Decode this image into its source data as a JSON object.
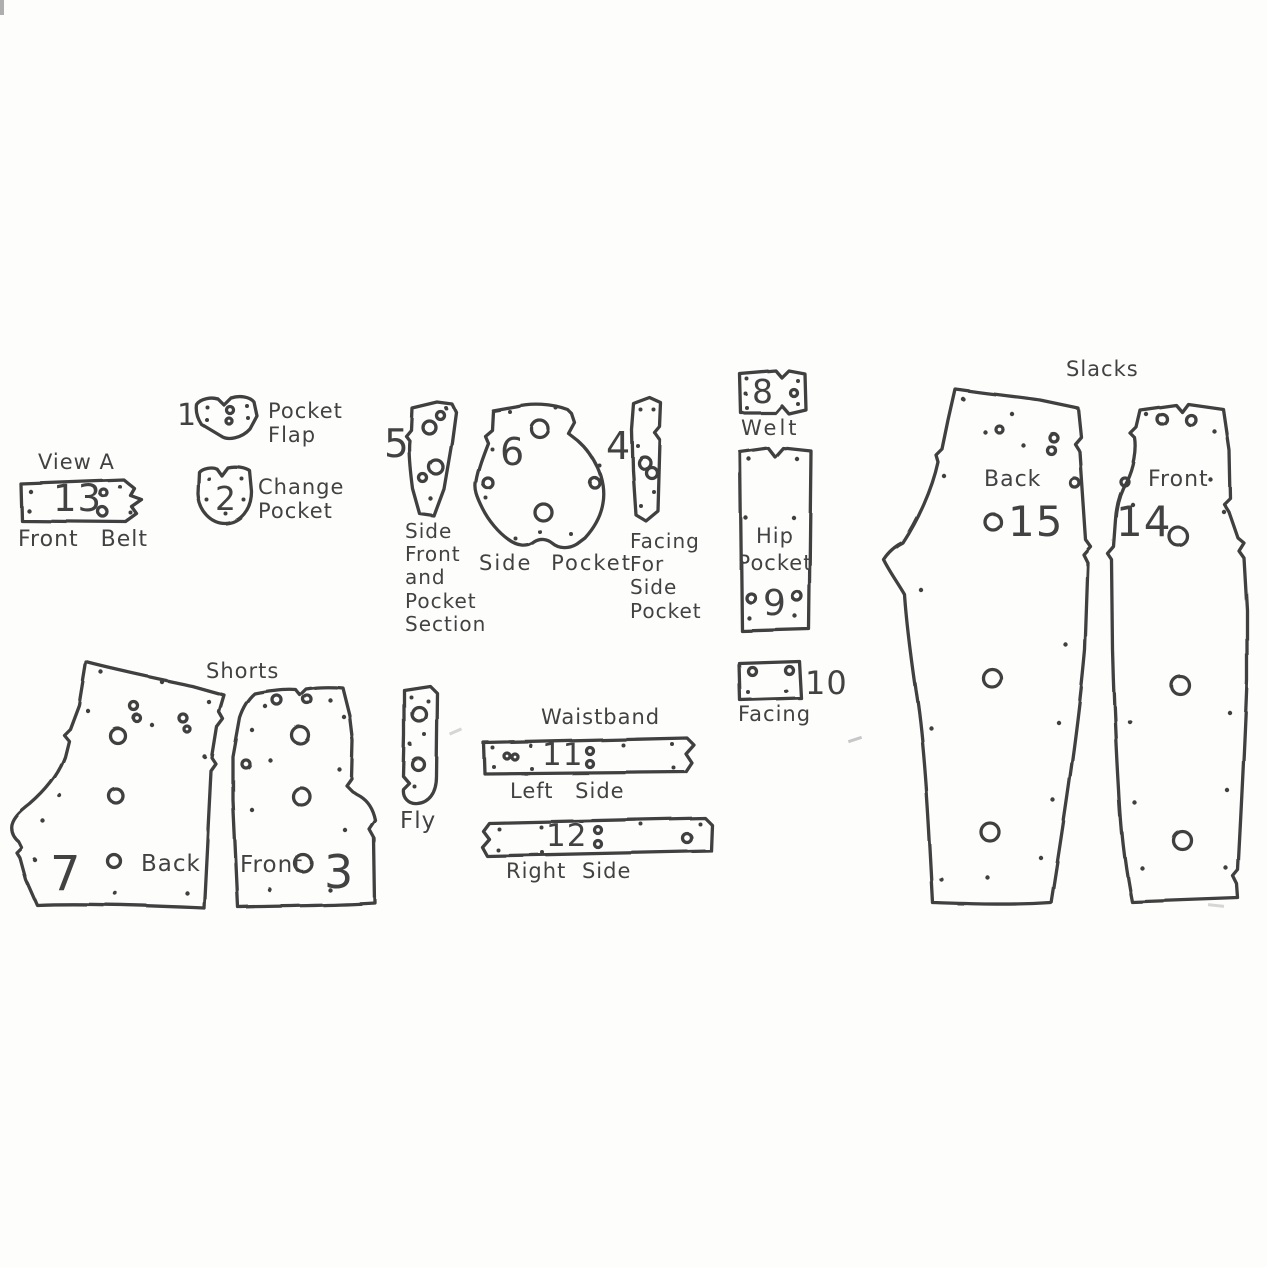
{
  "titles": {
    "view_a": "View A",
    "shorts": "Shorts",
    "slacks": "Slacks",
    "waistband": "Waistband"
  },
  "pieces": {
    "front_belt": {
      "num": "13",
      "label": "Front Belt"
    },
    "pocket_flap": {
      "num": "1",
      "label": "Pocket Flap"
    },
    "change_pocket": {
      "num": "2",
      "label": "Change Pocket"
    },
    "side_front": {
      "num": "5",
      "label": "Side Front and Pocket Section"
    },
    "side_pocket": {
      "num": "6",
      "label": "Side Pocket"
    },
    "side_pocket_facing": {
      "num": "4",
      "label": "Facing For Side Pocket"
    },
    "welt": {
      "num": "8",
      "label": "Welt"
    },
    "hip_pocket": {
      "num": "9",
      "label": "Hip Pocket"
    },
    "facing": {
      "num": "10",
      "label": "Facing"
    },
    "waistband_left": {
      "num": "11",
      "label": "Left Side"
    },
    "waistband_right": {
      "num": "12",
      "label": "Right Side"
    },
    "shorts_back": {
      "num": "7",
      "label": "Back"
    },
    "shorts_front": {
      "num": "3",
      "label": "Front"
    },
    "fly": {
      "label": "Fly"
    },
    "slacks_back": {
      "num": "15",
      "label": "Back"
    },
    "slacks_front": {
      "num": "14",
      "label": "Front"
    }
  },
  "ink_color": "#3f3f3f",
  "background_color": "#fdfdfc"
}
